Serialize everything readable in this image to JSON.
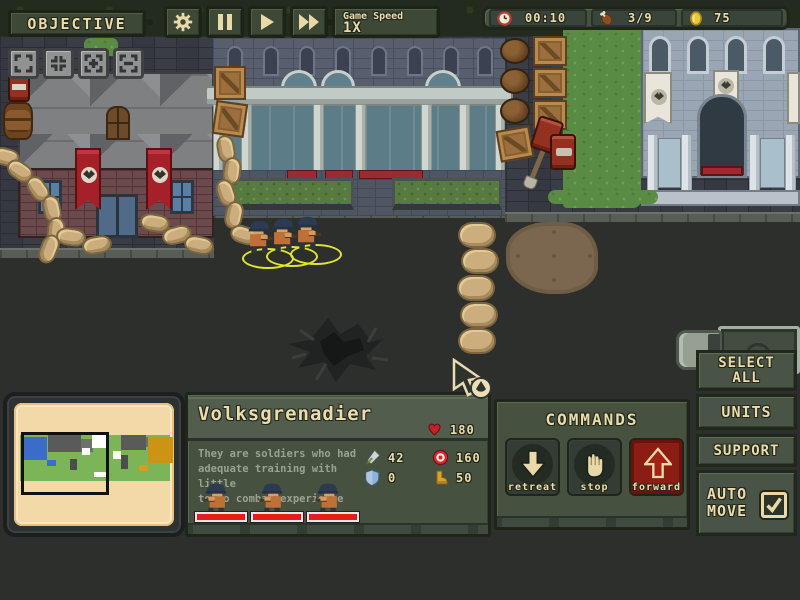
{
  "topbar": {
    "objective": "OBJECTIVE",
    "game_speed_label": "Game Speed",
    "game_speed_value": "1X"
  },
  "status": {
    "time": "00:10",
    "rations": "3/9",
    "gold": "75"
  },
  "unit": {
    "title": "Volksgrenadier",
    "hp": "180",
    "desc1": "They are soldiers who had",
    "desc2": "adequate training with little",
    "desc3": "to no combat experience",
    "attack": "42",
    "range": "160",
    "armor": "0",
    "cost": "50",
    "selected_count": 3
  },
  "commands": {
    "title": "COMMANDS",
    "retreat": "retreat",
    "stop": "stop",
    "forward": "forward"
  },
  "side": {
    "select_line1": "SELECT",
    "select_line2": "ALL",
    "units": "UNITS",
    "support": "SUPPORT",
    "auto_line1": "AUTO",
    "auto_line2": "MOVE",
    "auto_move_checked": true
  },
  "icons": {
    "timer": "clock-icon",
    "rations": "drumstick-icon",
    "currency": "coin-icon",
    "health": "heart-icon",
    "attack": "sword-icon",
    "range": "target-icon",
    "armor": "shield-icon",
    "cost": "boot-icon"
  },
  "palette": {
    "panel_olive": "#46513f",
    "cream_text": "#ecdcab",
    "health_red": "#e41c1c",
    "gold": "#e7c83b",
    "banner_red": "#a6202a",
    "selection_yellow": "#e0e52f"
  }
}
